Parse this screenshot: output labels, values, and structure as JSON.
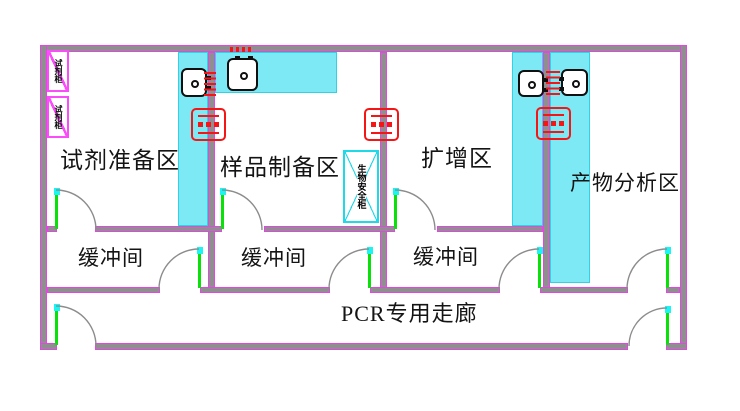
{
  "plan": {
    "colors": {
      "wall_core": "#8f8f8f",
      "wall_edge": "#e545e5",
      "bench_fill": "#7de9f4",
      "bench_edge": "#31d2e4",
      "cabinet_pink": "#f94df9",
      "biosafety_cyan": "#1fd8e8",
      "door_leaf_green": "#0ae00a",
      "door_cap_cyan": "#19f5f5",
      "arc_gray": "#8c8c8c",
      "marker_red": "#f51515",
      "text": "#141414",
      "background": "#ffffff"
    },
    "labels": [
      {
        "name": "room-label-reagent-prep",
        "text": "试剂准备区",
        "x": 60,
        "y": 148,
        "size": 23
      },
      {
        "name": "room-label-sample-prep",
        "text": "样品制备区",
        "x": 220,
        "y": 155,
        "size": 23
      },
      {
        "name": "room-label-amplification",
        "text": "扩增区",
        "x": 421,
        "y": 146,
        "size": 23
      },
      {
        "name": "room-label-product-analysis",
        "text": "产物分析区",
        "x": 570,
        "y": 171,
        "size": 21
      },
      {
        "name": "room-label-buffer-1",
        "text": "缓冲间",
        "x": 78,
        "y": 246,
        "size": 21
      },
      {
        "name": "room-label-buffer-2",
        "text": "缓冲间",
        "x": 241,
        "y": 246,
        "size": 21
      },
      {
        "name": "room-label-buffer-3",
        "text": "缓冲间",
        "x": 413,
        "y": 245,
        "size": 21
      },
      {
        "name": "room-label-corridor",
        "text": "PCR专用走廊",
        "x": 341,
        "y": 301,
        "size": 22
      }
    ],
    "walls": [
      {
        "x": 40,
        "y": 45,
        "w": 647,
        "h": 7
      },
      {
        "x": 40,
        "y": 45,
        "w": 7,
        "h": 305
      },
      {
        "x": 680,
        "y": 45,
        "w": 7,
        "h": 305
      },
      {
        "x": 40,
        "y": 343,
        "w": 17,
        "h": 7
      },
      {
        "x": 95,
        "y": 343,
        "w": 533,
        "h": 7
      },
      {
        "x": 666,
        "y": 343,
        "w": 21,
        "h": 7
      },
      {
        "x": 208,
        "y": 52,
        "w": 7,
        "h": 241
      },
      {
        "x": 380,
        "y": 52,
        "w": 7,
        "h": 241
      },
      {
        "x": 543,
        "y": 52,
        "w": 7,
        "h": 241
      },
      {
        "x": 47,
        "y": 226,
        "w": 10,
        "h": 6
      },
      {
        "x": 95,
        "y": 226,
        "w": 127,
        "h": 6
      },
      {
        "x": 264,
        "y": 226,
        "w": 131,
        "h": 6
      },
      {
        "x": 437,
        "y": 226,
        "w": 106,
        "h": 6
      },
      {
        "x": 47,
        "y": 287,
        "w": 113,
        "h": 6
      },
      {
        "x": 200,
        "y": 287,
        "w": 130,
        "h": 6
      },
      {
        "x": 370,
        "y": 287,
        "w": 130,
        "h": 6
      },
      {
        "x": 540,
        "y": 287,
        "w": 88,
        "h": 6
      },
      {
        "x": 666,
        "y": 287,
        "w": 14,
        "h": 6
      }
    ],
    "benches": [
      {
        "x": 178,
        "y": 52,
        "w": 30,
        "h": 174
      },
      {
        "x": 215,
        "y": 52,
        "w": 122,
        "h": 41
      },
      {
        "x": 512,
        "y": 52,
        "w": 31,
        "h": 174
      },
      {
        "x": 550,
        "y": 52,
        "w": 40,
        "h": 231
      }
    ],
    "cabinets": [
      {
        "x": 47,
        "y": 50,
        "w": 22,
        "h": 42,
        "label": "试剂柜"
      },
      {
        "x": 47,
        "y": 96,
        "w": 22,
        "h": 42,
        "label": "试剂柜"
      }
    ],
    "biosafety_cabinet": {
      "x": 343,
      "y": 150,
      "w": 36,
      "h": 73,
      "label": "生物安全柜"
    },
    "equipment": [
      {
        "x": 181,
        "y": 68,
        "w": 26,
        "h": 29,
        "tabs": "right"
      },
      {
        "x": 227,
        "y": 58,
        "w": 31,
        "h": 33,
        "tabs": "top"
      },
      {
        "x": 518,
        "y": 70,
        "w": 26,
        "h": 27,
        "tabs": "right"
      },
      {
        "x": 561,
        "y": 69,
        "w": 27,
        "h": 27,
        "tabs": "left"
      }
    ],
    "transfer_windows": [
      {
        "x": 191,
        "y": 108,
        "w": 35,
        "h": 33
      },
      {
        "x": 364,
        "y": 108,
        "w": 35,
        "h": 33
      },
      {
        "x": 536,
        "y": 107,
        "w": 35,
        "h": 33
      }
    ],
    "vent_markers": [
      {
        "x": 204,
        "y": 72,
        "w": 12,
        "h": 27,
        "dir": "v"
      },
      {
        "x": 546,
        "y": 71,
        "w": 14,
        "h": 27,
        "dir": "v"
      },
      {
        "x": 230,
        "y": 47,
        "w": 23,
        "h": 5,
        "dir": "h"
      }
    ],
    "door_leaves": [
      {
        "x": 55,
        "y": 189,
        "h": 40
      },
      {
        "x": 221,
        "y": 189,
        "h": 40
      },
      {
        "x": 394,
        "y": 189,
        "h": 40
      },
      {
        "x": 198,
        "y": 248,
        "h": 40
      },
      {
        "x": 368,
        "y": 248,
        "h": 40
      },
      {
        "x": 538,
        "y": 248,
        "h": 40
      },
      {
        "x": 666,
        "y": 248,
        "h": 40
      },
      {
        "x": 55,
        "y": 305,
        "h": 40
      },
      {
        "x": 666,
        "y": 307,
        "h": 38
      }
    ],
    "door_arcs": [
      "M 56 190 A 40 40 0 0 1 96 230",
      "M 222 190 A 40 40 0 0 1 262 230",
      "M 395 190 A 40 40 0 0 1 435 230",
      "M 199 249 A 40 40 0 0 0 159 289",
      "M 369 249 A 40 40 0 0 0 329 289",
      "M 539 249 A 40 40 0 0 0 499 289",
      "M 667 249 A 40 40 0 0 0 627 289",
      "M 56 306 A 40 40 0 0 1 96 346",
      "M 667 308 A 38 38 0 0 0 629 346"
    ]
  }
}
